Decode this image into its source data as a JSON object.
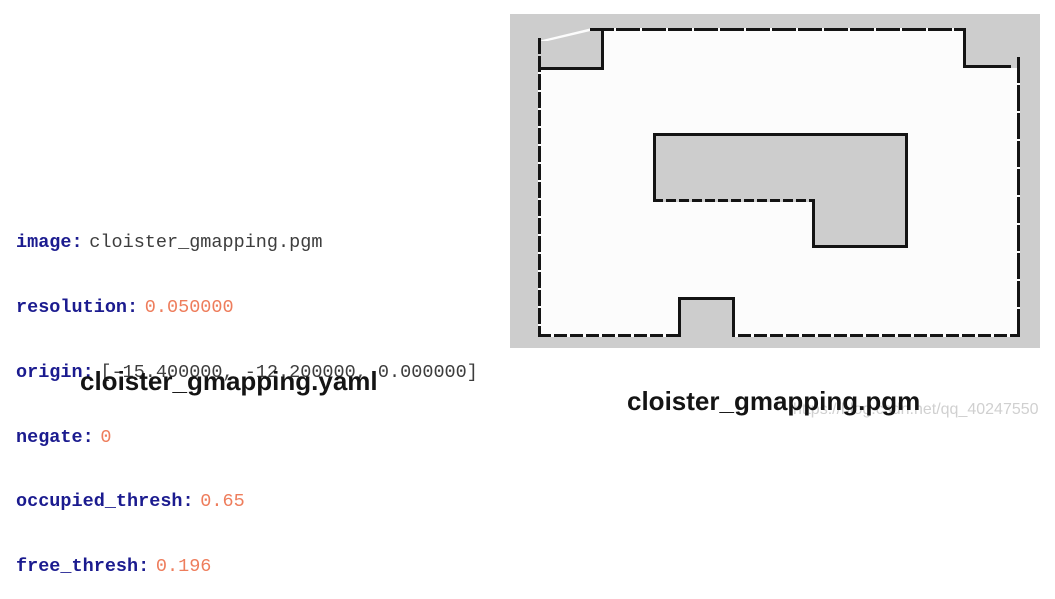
{
  "yaml_panel": {
    "caption": "cloister_gmapping.yaml",
    "colon": ":",
    "lines": [
      {
        "key": "image",
        "value": "cloister_gmapping.pgm"
      },
      {
        "key": "resolution",
        "value": "0.050000"
      },
      {
        "key": "origin",
        "value": "[-15.400000, -12.200000, 0.000000]"
      },
      {
        "key": "negate",
        "value": "0"
      },
      {
        "key": "occupied_thresh",
        "value": "0.65"
      },
      {
        "key": "free_thresh",
        "value": "0.196"
      }
    ],
    "colors": {
      "key": "#1b1b8f",
      "number_value": "#ee7d5c",
      "string_value": "#3d3d3d"
    }
  },
  "map_panel": {
    "caption": "cloister_gmapping.pgm",
    "colors": {
      "unknown": "#cdcdcd",
      "free": "#fcfcfc",
      "occupied": "#141414"
    }
  },
  "watermark": {
    "text": "https://blog.csdn.net/qq_40247550",
    "color": "#d0d0d0"
  }
}
